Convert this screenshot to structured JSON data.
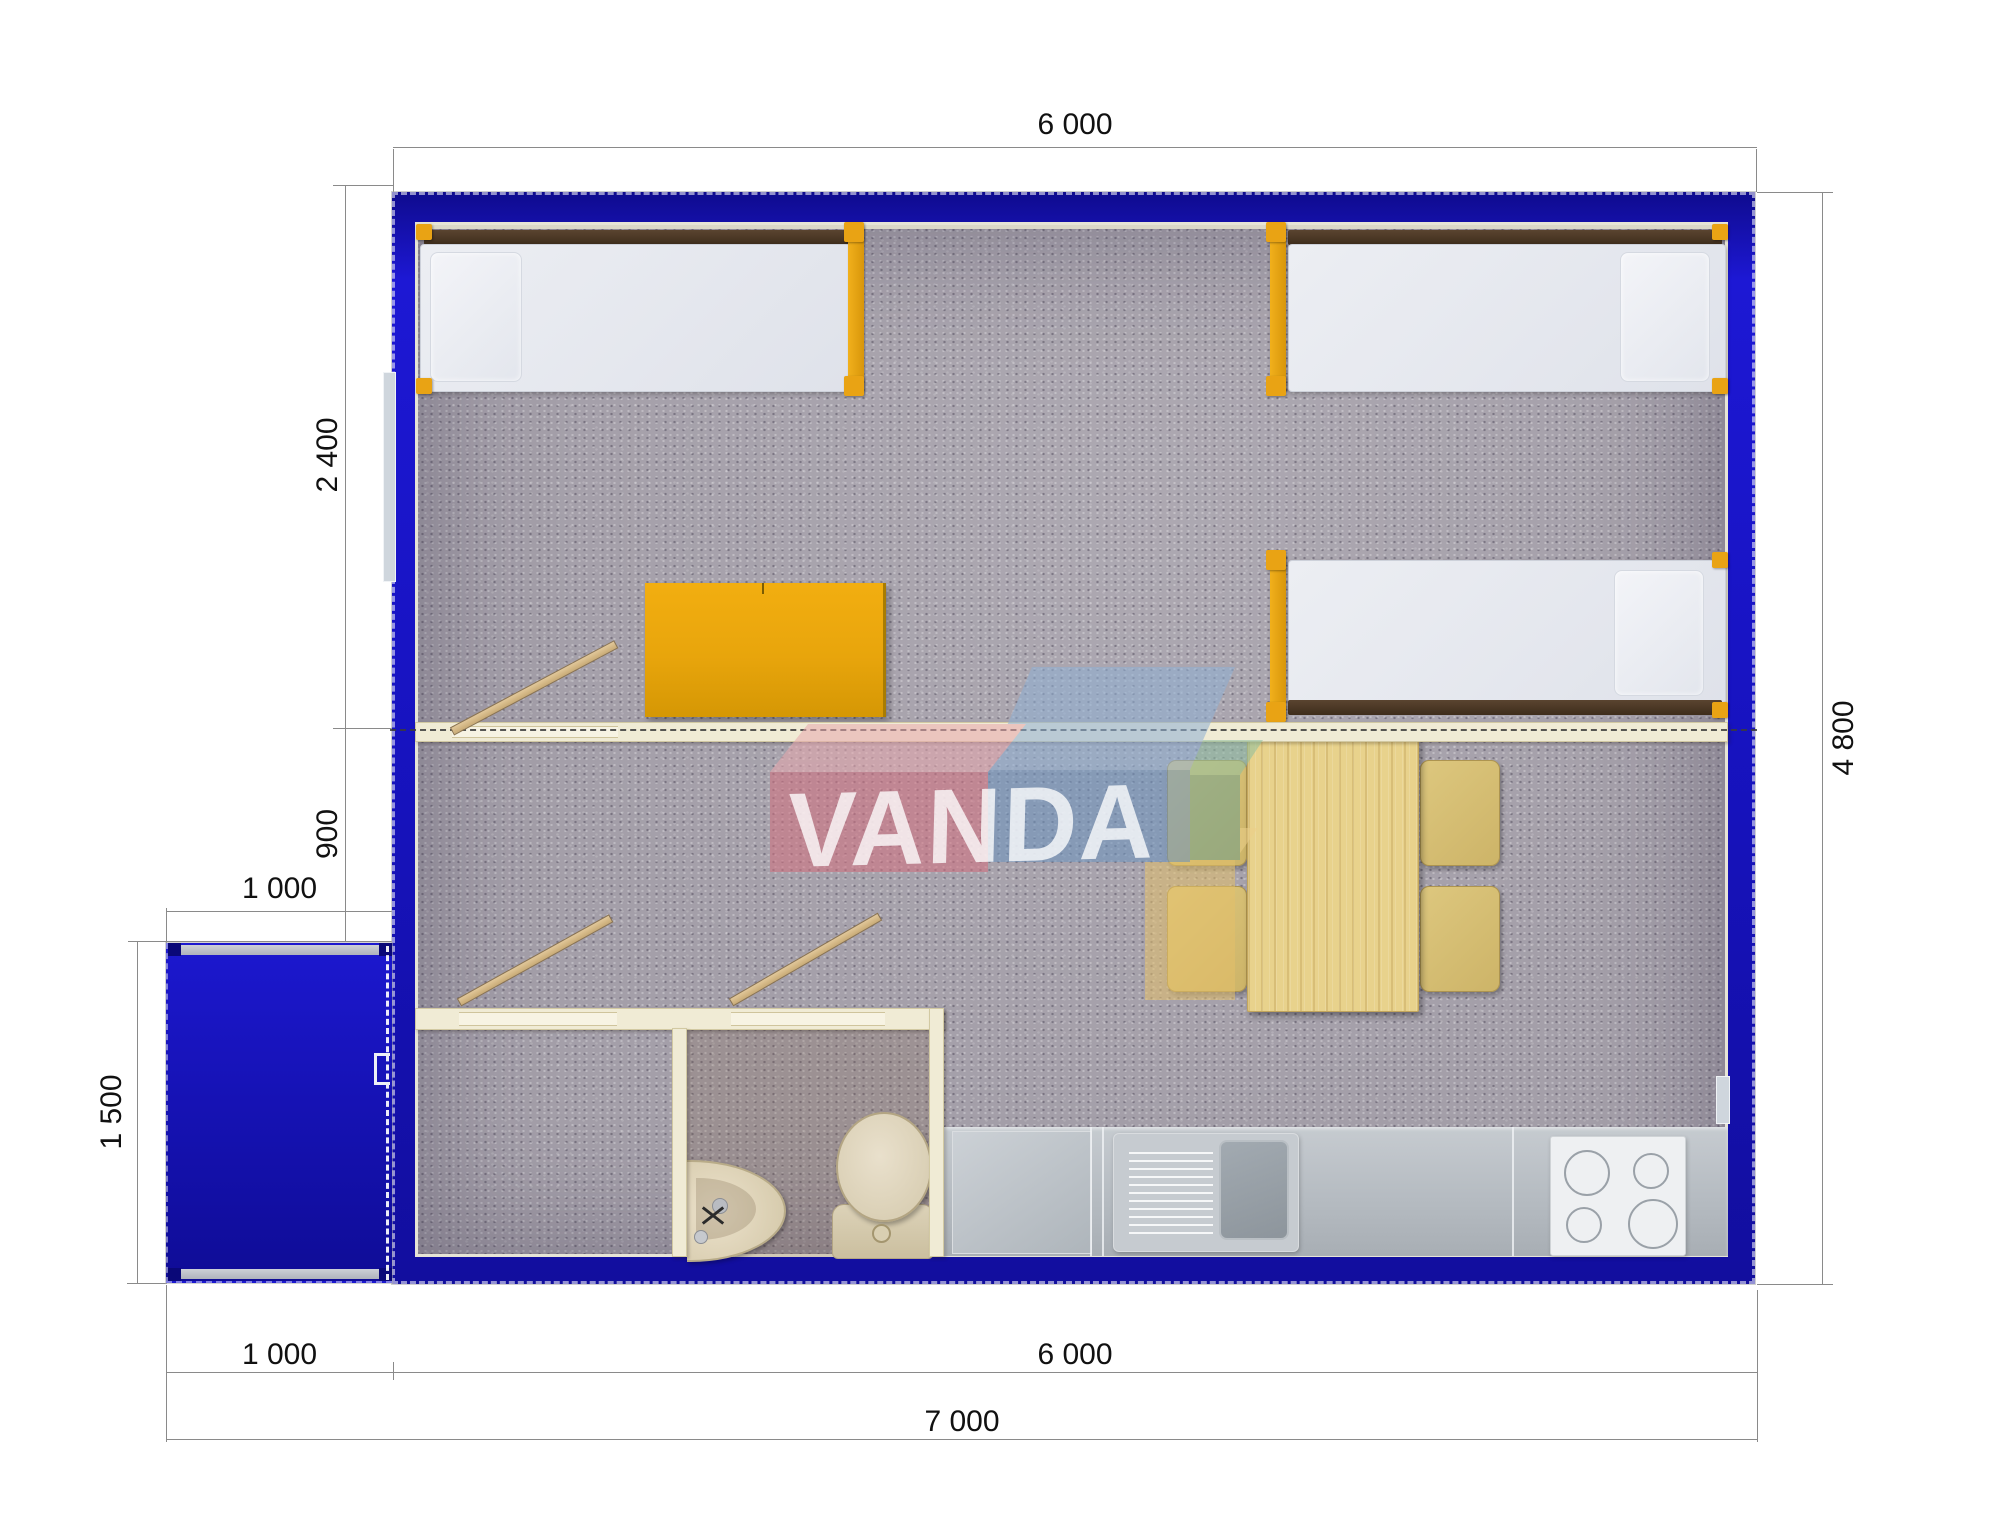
{
  "plan": {
    "title": "modular cabin floor plan",
    "watermark": {
      "text": "VANDA"
    },
    "dimensions": {
      "top_width": "6 000",
      "left_upper": "2 400",
      "left_mid": "900",
      "porch_width_top": "1 000",
      "porch_height": "1 500",
      "bottom_porch": "1 000",
      "bottom_main": "6 000",
      "bottom_total": "7 000",
      "right_height": "4 800"
    },
    "colors": {
      "wall_blue": "#1713c0",
      "frame_orange": "#e9a314",
      "wardrobe_orange": "#e8a50c",
      "wood": "#e8d28c",
      "partition_cream": "#f0ebd5"
    }
  }
}
